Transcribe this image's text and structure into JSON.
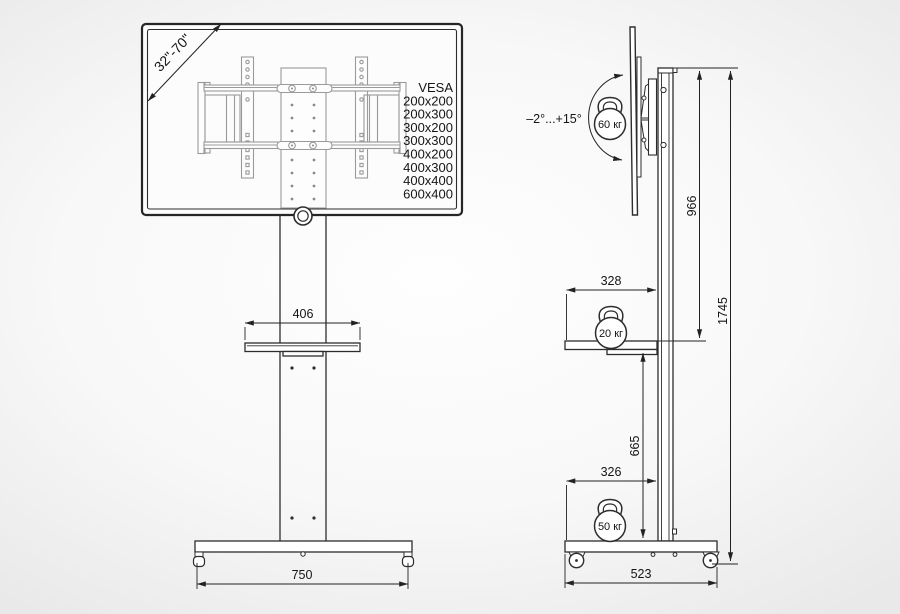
{
  "front_view": {
    "screen_size_range": "32\"-70\"",
    "vesa": {
      "title": "VESA",
      "sizes": [
        "200x200",
        "200x300",
        "300x200",
        "300x300",
        "400x200",
        "400x300",
        "400x400",
        "600x400"
      ]
    },
    "dims": {
      "shelf_width": "406",
      "base_width": "750"
    }
  },
  "side_view": {
    "tilt_range": "–2°...+15°",
    "loads": {
      "tv": "60 кг",
      "shelf": "20 кг",
      "base": "50 кг"
    },
    "dims": {
      "mount_height": "966",
      "total_height": "1745",
      "shelf_depth": "328",
      "shelf_to_base": "665",
      "base_inset": "326",
      "base_depth": "523"
    }
  },
  "style": {
    "line_color": "#2d2d2d",
    "detail_color": "#9a9a9a",
    "dim_color": "#222222",
    "bg_center": "#fdfdfd",
    "bg_edge": "#e9e9e9"
  }
}
